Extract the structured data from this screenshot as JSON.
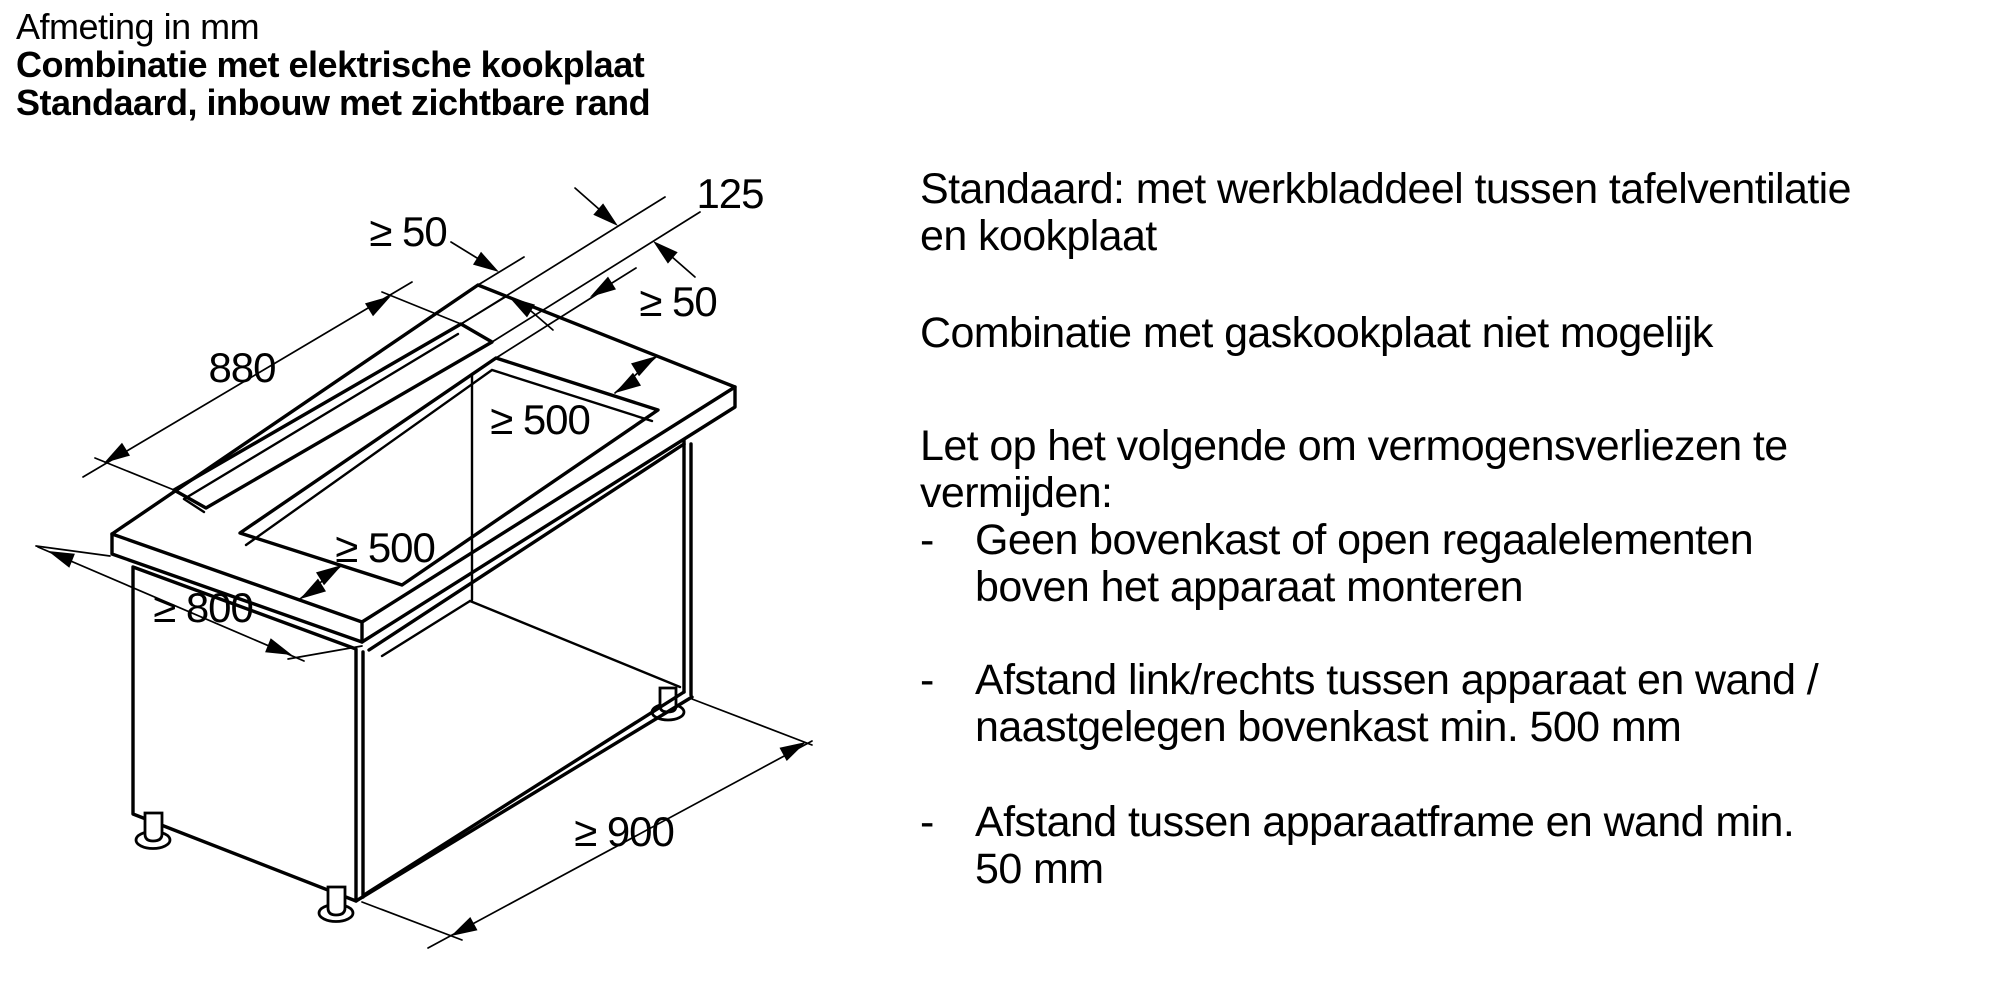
{
  "title": {
    "line1": "Afmeting in mm",
    "line2": "Combinatie met elektrische kookplaat",
    "line3": "Standaard, inbouw met zichtbare rand"
  },
  "diagram": {
    "dims": {
      "slot_length": "880",
      "slot_width": "125",
      "gap_back": "≥ 50",
      "gap_middle": "≥ 50",
      "clearance_right": "≥ 500",
      "clearance_front": "≥ 500",
      "worktop_depth": "≥ 800",
      "cabinet_width": "≥ 900"
    }
  },
  "right_column": {
    "para1": {
      "line1": "Standaard: met werkbladdeel tussen tafelventilatie",
      "line2": "en kookplaat"
    },
    "para2": {
      "line1": "Combinatie met gaskookplaat niet mogelijk"
    },
    "para3": {
      "line1": "Let op het volgende om vermogensverliezen te",
      "line2": "vermijden:"
    },
    "bullets": {
      "dash": "-",
      "b1": {
        "line1": "Geen bovenkast of open regaalelementen",
        "line2": "boven het apparaat monteren"
      },
      "b2": {
        "line1": "Afstand link/rechts tussen apparaat en wand /",
        "line2": "naastgelegen bovenkast min. 500 mm"
      },
      "b3": {
        "line1": "Afstand tussen apparaatframe en wand min.",
        "line2": "50 mm"
      }
    }
  },
  "colors": {
    "ink": "#000000",
    "background": "#ffffff"
  }
}
